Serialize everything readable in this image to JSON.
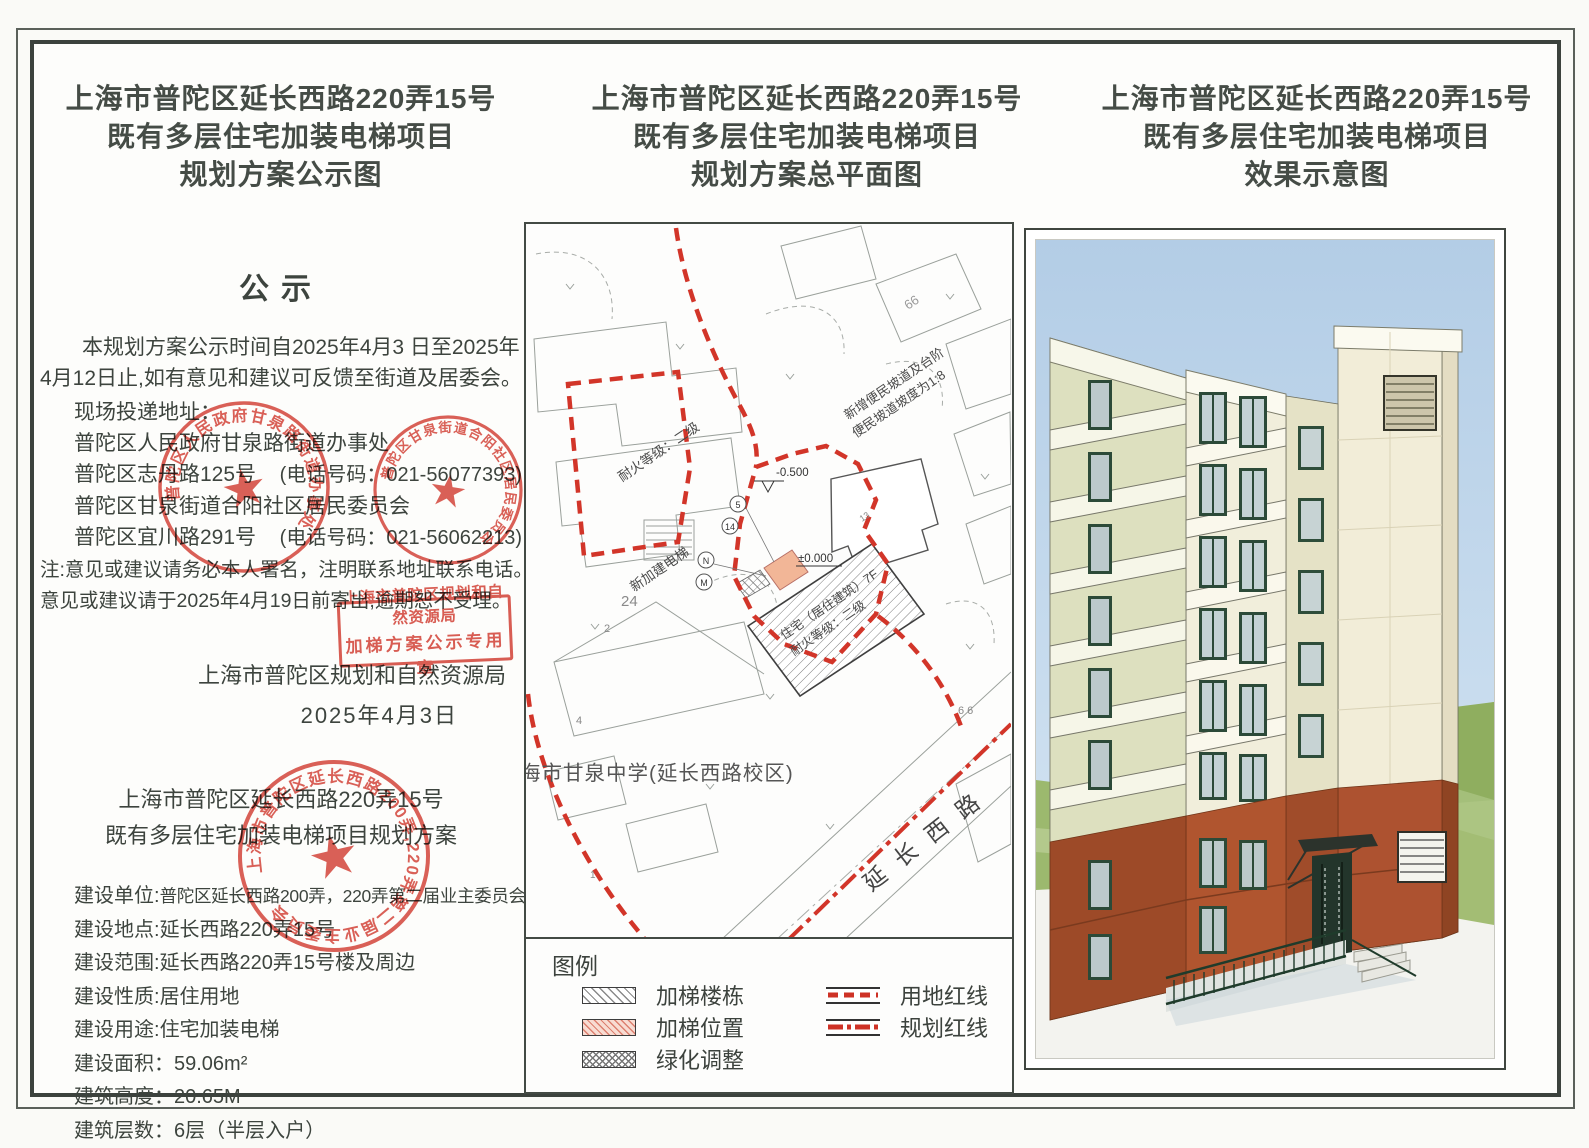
{
  "panels": {
    "left": {
      "title_lines": [
        "上海市普陀区延长西路220弄15号",
        "既有多层住宅加装电梯项目",
        "规划方案公示图"
      ]
    },
    "middle": {
      "title_lines": [
        "上海市普陀区延长西路220弄15号",
        "既有多层住宅加装电梯项目",
        "规划方案总平面图"
      ]
    },
    "right": {
      "title_lines": [
        "上海市普陀区延长西路220弄15号",
        "既有多层住宅加装电梯项目",
        "效果示意图"
      ]
    }
  },
  "notice": {
    "heading": "公示",
    "para1": "本规划方案公示时间自2025年4月3 日至2025年4月12日止,如有意见和建议可反馈至街道及居委会。",
    "address_intro": "现场投递地址：",
    "addresses": [
      {
        "name": "普陀区人民政府甘泉路街道办事处",
        "phone": ""
      },
      {
        "name": "普陀区志丹路125号",
        "phone": "(电话号码：021-56077393)"
      },
      {
        "name": "普陀区甘泉街道合阳社区居民委员会",
        "phone": ""
      },
      {
        "name": "普陀区宜川路291号",
        "phone": "(电话号码：021-56062213)"
      }
    ],
    "note1": "注:意见或建议请务必本人署名，注明联系地址联系电话。",
    "note2": "意见或建议请于2025年4月19日前寄出,逾期恕不受理。",
    "authority": "上海市普陀区规划和自然资源局",
    "date": "2025年4月3日"
  },
  "stamps": {
    "bureau_line1": "上海市普陀区规划和自然资源局",
    "bureau_line2": "加梯方案公示专用章",
    "street_office_ring": "普陀区人民政府甘泉路街道办事处",
    "residents_committee_ring": "普陀区甘泉街道合阳社区居民委员会",
    "owners_committee_ring": "上海市普陀区延长西路200弄,220弄第二届业主委员会",
    "star": "★"
  },
  "project": {
    "subtitle_lines": [
      "上海市普陀区延长西路220弄15号",
      "既有多层住宅加装电梯项目规划方案"
    ],
    "fields": [
      {
        "label": "建设单位:",
        "value": "普陀区延长西路200弄，220弄第二届业主委员会"
      },
      {
        "label": "建设地点:",
        "value": "延长西路220弄15号"
      },
      {
        "label": "建设范围:",
        "value": "延长西路220弄15号楼及周边"
      },
      {
        "label": "建设性质:",
        "value": "居住用地"
      },
      {
        "label": "建设用途:",
        "value": "住宅加装电梯"
      },
      {
        "label": "建设面积：",
        "value": "59.06m²"
      },
      {
        "label": "建筑高度：",
        "value": "20.65M"
      },
      {
        "label": "建筑层数：",
        "value": "6层（半层入户）"
      }
    ]
  },
  "map": {
    "labels": {
      "road": "延长西路",
      "school": "海市甘泉中学(延长西路校区)",
      "building_line1": "住宅（居住建筑）7F",
      "building_line2": "耐火等级：二级",
      "fire_rating": "耐火等级：二级",
      "new_elevator": "新加建电梯",
      "ramp_line1": "新增便民坡道及台阶",
      "ramp_line2": "便民坡道坡度为1:8",
      "level_top": "-0.500",
      "level_mid": "±0.000"
    },
    "plots": {
      "a": "24",
      "b": "66",
      "c": "13",
      "d": "2",
      "e": "4",
      "f": "1",
      "g": "6 6"
    },
    "markers": {
      "a": "5",
      "b": "14",
      "c": "N",
      "d": "M"
    },
    "legend": {
      "title": "图例",
      "items": [
        {
          "label": "加梯楼栋"
        },
        {
          "label": "加梯位置"
        },
        {
          "label": "绿化调整"
        },
        {
          "label": "用地红线"
        },
        {
          "label": "规划红线"
        }
      ]
    }
  },
  "colors": {
    "stamp_red": "#d5473c",
    "boundary_red": "#d23529",
    "elevator_orange": "#f2b18f",
    "terracotta": "#a9502c",
    "facade_cream": "#f1eedb"
  }
}
